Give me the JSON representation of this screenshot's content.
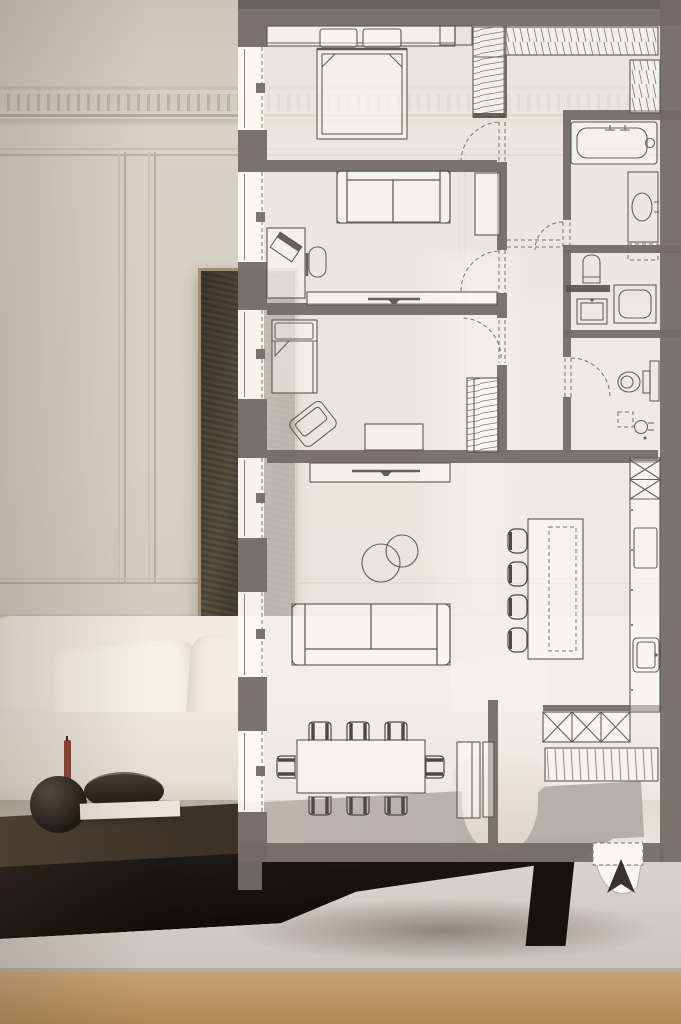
{
  "meta": {
    "scene": "apartment-floor-plan-overlay-on-interior-photo"
  },
  "palette": {
    "paper": "rgba(241,239,233,0.70)",
    "wall": "#716c66",
    "line": "#56524b",
    "dash_line": "#6b665f",
    "hatch": "#6a655e",
    "arrow": "#36332f",
    "entry_flag": "rgba(249,248,244,0.95)",
    "photo_wall": "#d8d3c8",
    "art_frame": "#a28f6f",
    "art_canvas": "#474338",
    "sofa_white": "#efebe3",
    "table_wood": "#2c251e",
    "rug": "#d3d0c9",
    "floor_wood": "#c09a69",
    "candle_red": "#8e4130"
  },
  "floor_plan": {
    "windows_on_left_wall": 6,
    "dining_chairs": 8,
    "bar_stools": 4,
    "entry_marker": "entrance-arrow-icon",
    "rooms": [
      "master-bedroom",
      "study-bedroom",
      "kids-room",
      "living-dining-room",
      "kitchen",
      "corridor",
      "bathroom",
      "laundry-wc",
      "guest-wc",
      "entry-hall"
    ],
    "furniture": [
      "double-bed",
      "pillows",
      "headboard-shelf",
      "wardrobe-hatched",
      "sofa",
      "desk",
      "laptop",
      "office-chair",
      "tall-cabinet",
      "media-console",
      "single-bed",
      "armchair",
      "dresser",
      "tv-console",
      "round-coffee-tables",
      "living-sofa",
      "dining-table",
      "dining-chairs",
      "sideboard",
      "kitchen-island",
      "bar-stools",
      "entry-closet-x",
      "shoe-cabinet"
    ],
    "fixtures": [
      "bathtub",
      "bath-faucet",
      "vanity-sink",
      "toilet",
      "utility-sink",
      "washing-machine",
      "wall-toilet",
      "bidet",
      "cooktop",
      "kitchen-sink",
      "tall-kitchen-units"
    ]
  },
  "photo": {
    "objects": [
      "crown-molding-dentils",
      "wall-paneling",
      "framed-artwork",
      "white-sofa",
      "throw-pillows",
      "dark-coffee-table",
      "red-candle",
      "round-black-vase",
      "dark-bowl-on-book",
      "pedestal-bowl",
      "area-rug",
      "wood-floor",
      "window-light-shaft"
    ]
  }
}
